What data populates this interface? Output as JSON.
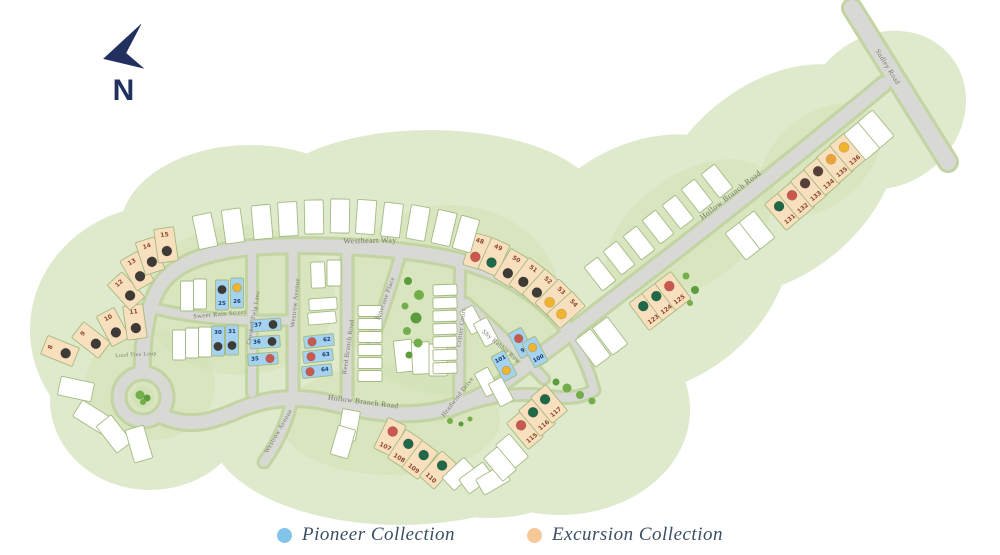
{
  "north": {
    "label": "N",
    "arrow_color": "#22305f"
  },
  "legend": {
    "items": [
      {
        "id": "pioneer",
        "label": "Pioneer Collection",
        "color": "#83c5ea"
      },
      {
        "id": "excursion",
        "label": "Excursion Collection",
        "color": "#f7c897"
      }
    ],
    "text_color": "#3a4e64"
  },
  "map": {
    "colors": {
      "land": "#dfe9cc",
      "patch": "#d2e2b5",
      "road": "#d8d9d4",
      "road_edge": "#c2d4a2",
      "lot_border": "#a4ba80",
      "street_text": "#76766a",
      "tree": "#74ad4c",
      "lot_fill": {
        "p": "#a5d2ef",
        "e": "#f8dfbd",
        "w": "#ffffff"
      },
      "num_fill": {
        "p": "#173a70",
        "e": "#8c4a2c"
      },
      "status": {
        "black": "#3e3a36",
        "brown": "#554139",
        "red": "#c9584e",
        "green": "#1f6848",
        "yellow": "#f0b42f",
        "orange": "#eca33b"
      }
    },
    "streets": [
      {
        "label": "Westheart Way",
        "x": 370,
        "y": 243,
        "rot": -1,
        "size": 8
      },
      {
        "label": "Hollow Branch Road",
        "x": 732,
        "y": 197,
        "rot": -38,
        "size": 8
      },
      {
        "label": "Hollow Branch Road",
        "x": 363,
        "y": 404,
        "rot": 7,
        "size": 7.5
      },
      {
        "label": "Sudley Road",
        "x": 886,
        "y": 68,
        "rot": 58,
        "size": 7
      },
      {
        "label": "Sweet Rain Street",
        "x": 220,
        "y": 316,
        "rot": -5,
        "size": 6.5
      },
      {
        "label": "Crooked Twig Lane",
        "x": 255,
        "y": 318,
        "rot": -80,
        "size": 6
      },
      {
        "label": "Westrow Avenue",
        "x": 297,
        "y": 303,
        "rot": -84,
        "size": 6.5
      },
      {
        "label": "Westrow Avenue",
        "x": 280,
        "y": 432,
        "rot": -60,
        "size": 6.5
      },
      {
        "label": "Reed Branch Road",
        "x": 350,
        "y": 347,
        "rot": -82,
        "size": 6.5
      },
      {
        "label": "Pinecone Place",
        "x": 387,
        "y": 299,
        "rot": -70,
        "size": 6.5
      },
      {
        "label": "Critter Court",
        "x": 463,
        "y": 328,
        "rot": -82,
        "size": 6.5
      },
      {
        "label": "Shy Rabbit Row",
        "x": 500,
        "y": 348,
        "rot": 41,
        "size": 6.5
      },
      {
        "label": "Headwind Drive",
        "x": 459,
        "y": 398,
        "rot": -52,
        "size": 6.5
      },
      {
        "label": "Loud Tree Loop",
        "x": 136,
        "y": 356,
        "rot": -3,
        "size": 5.5
      }
    ],
    "lots": [
      {
        "n": "8",
        "c": "e",
        "d": "black",
        "x": 60,
        "y": 351,
        "r": -68,
        "o": "nt"
      },
      {
        "n": "9",
        "c": "e",
        "d": "black",
        "x": 91,
        "y": 340,
        "r": -52,
        "o": "nt"
      },
      {
        "n": "10",
        "c": "e",
        "d": "black",
        "x": 113,
        "y": 327,
        "r": -28,
        "o": "nt"
      },
      {
        "n": "11",
        "c": "e",
        "d": "black",
        "x": 135,
        "y": 322,
        "r": -8,
        "o": "nt"
      },
      {
        "n": "12",
        "c": "e",
        "d": "black",
        "x": 126,
        "y": 291,
        "r": -42,
        "o": "nt"
      },
      {
        "n": "13",
        "c": "e",
        "d": "black",
        "x": 137,
        "y": 271,
        "r": -30,
        "o": "nt"
      },
      {
        "n": "14",
        "c": "e",
        "d": "black",
        "x": 150,
        "y": 256,
        "r": -18,
        "o": "nt"
      },
      {
        "n": "15",
        "c": "e",
        "d": "black",
        "x": 166,
        "y": 245,
        "r": -8,
        "o": "nt"
      },
      {
        "n": "48",
        "c": "e",
        "d": "red",
        "x": 477,
        "y": 251,
        "r": 16,
        "o": "nt"
      },
      {
        "n": "49",
        "c": "e",
        "d": "green",
        "x": 494,
        "y": 257,
        "r": 24,
        "o": "nt"
      },
      {
        "n": "50",
        "c": "e",
        "d": "black",
        "x": 511,
        "y": 268,
        "r": 31,
        "o": "nt"
      },
      {
        "n": "51",
        "c": "e",
        "d": "black",
        "x": 527,
        "y": 277,
        "r": 37,
        "o": "nt"
      },
      {
        "n": "52",
        "c": "e",
        "d": "black",
        "x": 541,
        "y": 288,
        "r": 42,
        "o": "nt"
      },
      {
        "n": "53",
        "c": "e",
        "d": "yellow",
        "x": 554,
        "y": 298,
        "r": 45,
        "o": "nt"
      },
      {
        "n": "54",
        "c": "e",
        "d": "yellow",
        "x": 566,
        "y": 310,
        "r": 48,
        "o": "nt"
      },
      {
        "n": "107",
        "c": "e",
        "d": "red",
        "x": 390,
        "y": 437,
        "r": 26,
        "o": "nb"
      },
      {
        "n": "108",
        "c": "e",
        "d": "green",
        "x": 405,
        "y": 449,
        "r": 33,
        "o": "nb"
      },
      {
        "n": "109",
        "c": "e",
        "d": "green",
        "x": 420,
        "y": 460,
        "r": 37,
        "o": "nb"
      },
      {
        "n": "110",
        "c": "e",
        "d": "green",
        "x": 438,
        "y": 470,
        "r": 42,
        "o": "nb"
      },
      {
        "n": "115",
        "c": "e",
        "d": "red",
        "x": 525,
        "y": 430,
        "r": -40,
        "o": "nb"
      },
      {
        "n": "116",
        "c": "e",
        "d": "green",
        "x": 537,
        "y": 417,
        "r": -40,
        "o": "nb"
      },
      {
        "n": "117",
        "c": "e",
        "d": "green",
        "x": 549,
        "y": 404,
        "r": -40,
        "o": "nb"
      },
      {
        "n": "123",
        "c": "e",
        "d": "green",
        "x": 647,
        "y": 311,
        "r": -37,
        "o": "nb"
      },
      {
        "n": "124",
        "c": "e",
        "d": "green",
        "x": 660,
        "y": 301,
        "r": -37,
        "o": "nb"
      },
      {
        "n": "125",
        "c": "e",
        "d": "red",
        "x": 673,
        "y": 291,
        "r": -37,
        "o": "nb"
      },
      {
        "n": "131",
        "c": "e",
        "d": "green",
        "x": 783,
        "y": 211,
        "r": -40,
        "o": "nb"
      },
      {
        "n": "132",
        "c": "e",
        "d": "red",
        "x": 796,
        "y": 200,
        "r": -40,
        "o": "nb"
      },
      {
        "n": "133",
        "c": "e",
        "d": "brown",
        "x": 809,
        "y": 188,
        "r": -40,
        "o": "nb"
      },
      {
        "n": "134",
        "c": "e",
        "d": "brown",
        "x": 822,
        "y": 176,
        "r": -40,
        "o": "nb"
      },
      {
        "n": "135",
        "c": "e",
        "d": "orange",
        "x": 835,
        "y": 164,
        "r": -40,
        "o": "nb"
      },
      {
        "n": "136",
        "c": "e",
        "d": "yellow",
        "x": 848,
        "y": 152,
        "r": -40,
        "o": "nb"
      },
      {
        "n": "25",
        "c": "p",
        "d": "black",
        "x": 222,
        "y": 295,
        "r": 0,
        "w": 13,
        "h": 30,
        "o": "nb"
      },
      {
        "n": "26",
        "c": "p",
        "d": "yellow",
        "x": 237,
        "y": 293,
        "r": 0,
        "w": 13,
        "h": 30,
        "o": "nb"
      },
      {
        "n": "30",
        "c": "p",
        "d": "black",
        "x": 218,
        "y": 341,
        "r": 0,
        "w": 13,
        "h": 30,
        "o": "nt"
      },
      {
        "n": "31",
        "c": "p",
        "d": "black",
        "x": 232,
        "y": 340,
        "r": 0,
        "w": 13,
        "h": 30,
        "o": "nt"
      },
      {
        "n": "37",
        "c": "p",
        "d": "black",
        "x": 266,
        "y": 325,
        "r": -4,
        "w": 30,
        "h": 12,
        "o": "nl"
      },
      {
        "n": "36",
        "c": "p",
        "d": "black",
        "x": 265,
        "y": 342,
        "r": -4,
        "w": 30,
        "h": 12,
        "o": "nl"
      },
      {
        "n": "35",
        "c": "p",
        "d": "red",
        "x": 263,
        "y": 359,
        "r": -4,
        "w": 30,
        "h": 12,
        "o": "nl"
      },
      {
        "n": "62",
        "c": "p",
        "d": "red",
        "x": 319,
        "y": 341,
        "r": -6,
        "w": 30,
        "h": 12,
        "o": "nr"
      },
      {
        "n": "63",
        "c": "p",
        "d": "red",
        "x": 318,
        "y": 356,
        "r": -6,
        "w": 30,
        "h": 12,
        "o": "nr"
      },
      {
        "n": "64",
        "c": "p",
        "d": "red",
        "x": 317,
        "y": 371,
        "r": -6,
        "w": 30,
        "h": 12,
        "o": "nr"
      },
      {
        "n": "99",
        "c": "p",
        "d": "red",
        "x": 521,
        "y": 343,
        "r": -28,
        "w": 15,
        "h": 28,
        "o": "nb"
      },
      {
        "n": "100",
        "c": "p",
        "d": "yellow",
        "x": 535,
        "y": 352,
        "r": -28,
        "w": 15,
        "h": 28,
        "o": "nb"
      },
      {
        "n": "101",
        "c": "p",
        "d": "yellow",
        "x": 504,
        "y": 366,
        "r": -28,
        "w": 15,
        "h": 28,
        "o": "nt"
      },
      {
        "n": "",
        "c": "w",
        "d": "",
        "x": 205,
        "y": 231,
        "r": -12
      },
      {
        "n": "",
        "c": "w",
        "d": "",
        "x": 233,
        "y": 226,
        "r": -8
      },
      {
        "n": "",
        "c": "w",
        "d": "",
        "x": 262,
        "y": 222,
        "r": -5
      },
      {
        "n": "",
        "c": "w",
        "d": "",
        "x": 288,
        "y": 219,
        "r": -3
      },
      {
        "n": "",
        "c": "w",
        "d": "",
        "x": 314,
        "y": 217,
        "r": -1
      },
      {
        "n": "",
        "c": "w",
        "d": "",
        "x": 340,
        "y": 216,
        "r": 1
      },
      {
        "n": "",
        "c": "w",
        "d": "",
        "x": 366,
        "y": 217,
        "r": 4
      },
      {
        "n": "",
        "c": "w",
        "d": "",
        "x": 392,
        "y": 220,
        "r": 7
      },
      {
        "n": "",
        "c": "w",
        "d": "",
        "x": 418,
        "y": 223,
        "r": 10
      },
      {
        "n": "",
        "c": "w",
        "d": "",
        "x": 444,
        "y": 228,
        "r": 13
      },
      {
        "n": "",
        "c": "w",
        "d": "",
        "x": 466,
        "y": 234,
        "r": 16
      },
      {
        "n": "",
        "c": "w",
        "d": "",
        "x": 600,
        "y": 274,
        "r": -38,
        "w": 17,
        "h": 30
      },
      {
        "n": "",
        "c": "w",
        "d": "",
        "x": 619,
        "y": 258,
        "r": -38,
        "w": 17,
        "h": 30
      },
      {
        "n": "",
        "c": "w",
        "d": "",
        "x": 639,
        "y": 243,
        "r": -38,
        "w": 17,
        "h": 30
      },
      {
        "n": "",
        "c": "w",
        "d": "",
        "x": 658,
        "y": 227,
        "r": -38,
        "w": 17,
        "h": 30
      },
      {
        "n": "",
        "c": "w",
        "d": "",
        "x": 678,
        "y": 212,
        "r": -38,
        "w": 17,
        "h": 30
      },
      {
        "n": "",
        "c": "w",
        "d": "",
        "x": 697,
        "y": 196,
        "r": -38,
        "w": 17,
        "h": 30
      },
      {
        "n": "",
        "c": "w",
        "d": "",
        "x": 717,
        "y": 181,
        "r": -38,
        "w": 17,
        "h": 30
      },
      {
        "n": "",
        "c": "w",
        "d": "",
        "x": 610,
        "y": 336,
        "r": -37
      },
      {
        "n": "",
        "c": "w",
        "d": "",
        "x": 593,
        "y": 348,
        "r": -37
      },
      {
        "n": "",
        "c": "w",
        "d": "",
        "x": 743,
        "y": 241,
        "r": -38
      },
      {
        "n": "",
        "c": "w",
        "d": "",
        "x": 757,
        "y": 230,
        "r": -38
      },
      {
        "n": "",
        "c": "w",
        "d": "",
        "x": 862,
        "y": 141,
        "r": -40
      },
      {
        "n": "",
        "c": "w",
        "d": "",
        "x": 876,
        "y": 129,
        "r": -40
      },
      {
        "n": "",
        "c": "w",
        "d": "",
        "x": 187,
        "y": 296,
        "r": 0,
        "w": 13,
        "h": 30
      },
      {
        "n": "",
        "c": "w",
        "d": "",
        "x": 200,
        "y": 294,
        "r": 0,
        "w": 13,
        "h": 30
      },
      {
        "n": "",
        "c": "w",
        "d": "",
        "x": 179,
        "y": 345,
        "r": 0,
        "w": 13,
        "h": 30
      },
      {
        "n": "",
        "c": "w",
        "d": "",
        "x": 192,
        "y": 343,
        "r": 0,
        "w": 13,
        "h": 30
      },
      {
        "n": "",
        "c": "w",
        "d": "",
        "x": 205,
        "y": 342,
        "r": 0,
        "w": 13,
        "h": 30
      },
      {
        "n": "",
        "c": "w",
        "d": "",
        "x": 323,
        "y": 304,
        "r": -4,
        "w": 28,
        "h": 12
      },
      {
        "n": "",
        "c": "w",
        "d": "",
        "x": 322,
        "y": 318,
        "r": -5,
        "w": 28,
        "h": 12
      },
      {
        "n": "",
        "c": "w",
        "d": "",
        "x": 318,
        "y": 275,
        "r": -2,
        "w": 14,
        "h": 26
      },
      {
        "n": "",
        "c": "w",
        "d": "",
        "x": 334,
        "y": 273,
        "r": 0,
        "w": 14,
        "h": 26
      },
      {
        "n": "",
        "c": "w",
        "d": "",
        "x": 370,
        "y": 311,
        "r": 0,
        "w": 24,
        "h": 11
      },
      {
        "n": "",
        "c": "w",
        "d": "",
        "x": 370,
        "y": 324,
        "r": 0,
        "w": 24,
        "h": 11
      },
      {
        "n": "",
        "c": "w",
        "d": "",
        "x": 370,
        "y": 337,
        "r": 0,
        "w": 24,
        "h": 11
      },
      {
        "n": "",
        "c": "w",
        "d": "",
        "x": 370,
        "y": 350,
        "r": 0,
        "w": 24,
        "h": 11
      },
      {
        "n": "",
        "c": "w",
        "d": "",
        "x": 370,
        "y": 363,
        "r": 0,
        "w": 24,
        "h": 11
      },
      {
        "n": "",
        "c": "w",
        "d": "",
        "x": 370,
        "y": 376,
        "r": 0,
        "w": 24,
        "h": 11
      },
      {
        "n": "",
        "c": "w",
        "d": "",
        "x": 404,
        "y": 356,
        "r": -6,
        "w": 18,
        "h": 32
      },
      {
        "n": "",
        "c": "w",
        "d": "",
        "x": 421,
        "y": 358,
        "r": -3,
        "w": 18,
        "h": 32
      },
      {
        "n": "",
        "c": "w",
        "d": "",
        "x": 438,
        "y": 360,
        "r": 0,
        "w": 18,
        "h": 32
      },
      {
        "n": "",
        "c": "w",
        "d": "",
        "x": 445,
        "y": 290,
        "r": -2,
        "w": 24,
        "h": 11
      },
      {
        "n": "",
        "c": "w",
        "d": "",
        "x": 445,
        "y": 303,
        "r": -2,
        "w": 24,
        "h": 11
      },
      {
        "n": "",
        "c": "w",
        "d": "",
        "x": 445,
        "y": 316,
        "r": -2,
        "w": 24,
        "h": 11
      },
      {
        "n": "",
        "c": "w",
        "d": "",
        "x": 445,
        "y": 329,
        "r": -2,
        "w": 24,
        "h": 11
      },
      {
        "n": "",
        "c": "w",
        "d": "",
        "x": 445,
        "y": 342,
        "r": -2,
        "w": 24,
        "h": 11
      },
      {
        "n": "",
        "c": "w",
        "d": "",
        "x": 445,
        "y": 355,
        "r": -2,
        "w": 24,
        "h": 11
      },
      {
        "n": "",
        "c": "w",
        "d": "",
        "x": 445,
        "y": 368,
        "r": -2,
        "w": 24,
        "h": 11
      },
      {
        "n": "",
        "c": "w",
        "d": "",
        "x": 472,
        "y": 320,
        "r": -28,
        "w": 15,
        "h": 26
      },
      {
        "n": "",
        "c": "w",
        "d": "",
        "x": 486,
        "y": 332,
        "r": -28,
        "w": 15,
        "h": 26
      },
      {
        "n": "",
        "c": "w",
        "d": "",
        "x": 487,
        "y": 382,
        "r": -28,
        "w": 15,
        "h": 26
      },
      {
        "n": "",
        "c": "w",
        "d": "",
        "x": 501,
        "y": 392,
        "r": -28,
        "w": 15,
        "h": 26
      },
      {
        "n": "",
        "c": "w",
        "d": "",
        "x": 349,
        "y": 425,
        "r": 10,
        "w": 18,
        "h": 30
      },
      {
        "n": "",
        "c": "w",
        "d": "",
        "x": 343,
        "y": 442,
        "r": 16,
        "w": 18,
        "h": 30
      },
      {
        "n": "",
        "c": "w",
        "d": "",
        "x": 459,
        "y": 474,
        "r": 47,
        "w": 18,
        "h": 30
      },
      {
        "n": "",
        "c": "w",
        "d": "",
        "x": 476,
        "y": 478,
        "r": 54,
        "w": 18,
        "h": 30
      },
      {
        "n": "",
        "c": "w",
        "d": "",
        "x": 493,
        "y": 480,
        "r": 60,
        "w": 18,
        "h": 30
      },
      {
        "n": "",
        "c": "w",
        "d": "",
        "x": 512,
        "y": 451,
        "r": -40,
        "w": 18,
        "h": 30
      },
      {
        "n": "",
        "c": "w",
        "d": "",
        "x": 500,
        "y": 464,
        "r": -40,
        "w": 18,
        "h": 30
      },
      {
        "n": "",
        "c": "w",
        "d": "",
        "x": 76,
        "y": 389,
        "r": -78
      },
      {
        "n": "",
        "c": "w",
        "d": "",
        "x": 92,
        "y": 417,
        "r": -58
      },
      {
        "n": "",
        "c": "w",
        "d": "",
        "x": 114,
        "y": 434,
        "r": -38
      },
      {
        "n": "",
        "c": "w",
        "d": "",
        "x": 139,
        "y": 444,
        "r": -16
      }
    ]
  }
}
